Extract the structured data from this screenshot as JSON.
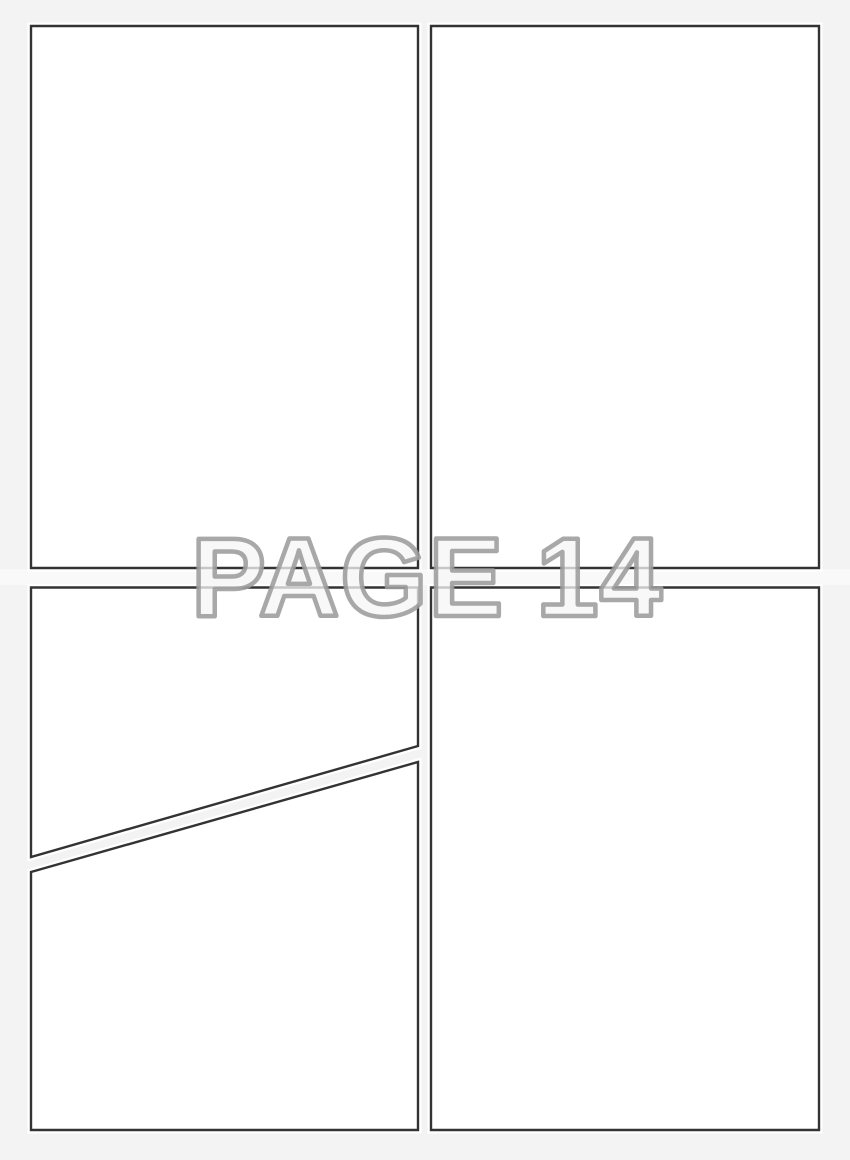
{
  "page": {
    "label": "PAGE 14",
    "description": "Blank five-panel comic book page template"
  },
  "panels": [
    {
      "id": "panel-1",
      "position": "top-left",
      "shape": "rectangle"
    },
    {
      "id": "panel-2",
      "position": "top-right",
      "shape": "rectangle"
    },
    {
      "id": "panel-3",
      "position": "middle-left",
      "shape": "rectangle-with-diagonal-bottom"
    },
    {
      "id": "panel-4",
      "position": "bottom-left",
      "shape": "rectangle-with-diagonal-top"
    },
    {
      "id": "panel-5",
      "position": "bottom-right",
      "shape": "rectangle"
    }
  ],
  "colors": {
    "background": "#f3f3f3",
    "panel_fill": "#ffffff",
    "panel_border": "#333333",
    "panel_halo": "#ffffff",
    "label_fill": "#f6f6f6",
    "label_outline": "#9c9c9c",
    "gutter_band": "#ffffff"
  }
}
